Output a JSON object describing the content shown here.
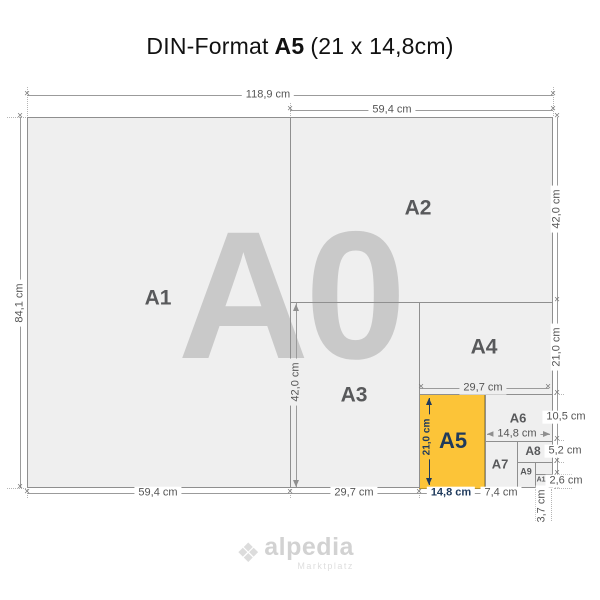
{
  "title": {
    "prefix": "DIN-Format",
    "format_name": "A5",
    "format_size": "(21 x 14,8cm)"
  },
  "watermark": "A0",
  "regions": {
    "a1": "A1",
    "a2": "A2",
    "a3": "A3",
    "a4": "A4",
    "a5": "A5",
    "a6": "A6",
    "a7": "A7",
    "a8": "A8",
    "a9": "A9",
    "a10": "A10"
  },
  "dims": {
    "top_total": "118,9 cm",
    "top_a2_width": "59,4 cm",
    "left_a0_height": "84,1 cm",
    "right_a2_height": "42,0 cm",
    "right_a4_height": "21,0 cm",
    "right_a6_height": "10,5 cm",
    "right_a8_height": "5,2 cm",
    "right_a10_height": "2,6 cm",
    "inner_a3_height": "42,0 cm",
    "inner_a4_width": "29,7 cm",
    "inner_a5_height": "21,0 cm",
    "inner_a6_width": "14,8 cm",
    "bottom_a1_width": "59,4 cm",
    "bottom_a3_width": "29,7 cm",
    "bottom_a5_width": "14,8 cm",
    "bottom_a7_width": "7,4 cm",
    "bottom_a9_width": "3,7 cm"
  },
  "logo": {
    "mark": "❖",
    "name": "alpedia",
    "tagline": "Marktplatz"
  },
  "colors": {
    "accent_orange": "#fcc438",
    "navy": "#1f3a5c",
    "sheet_fill": "#efefef",
    "line": "#8f8f8f",
    "dim_text": "#555555",
    "label_text": "#58595b",
    "watermark_fill": "#c9c9c9",
    "logo_gray": "#d2d2d2",
    "title_color": "#111111"
  }
}
